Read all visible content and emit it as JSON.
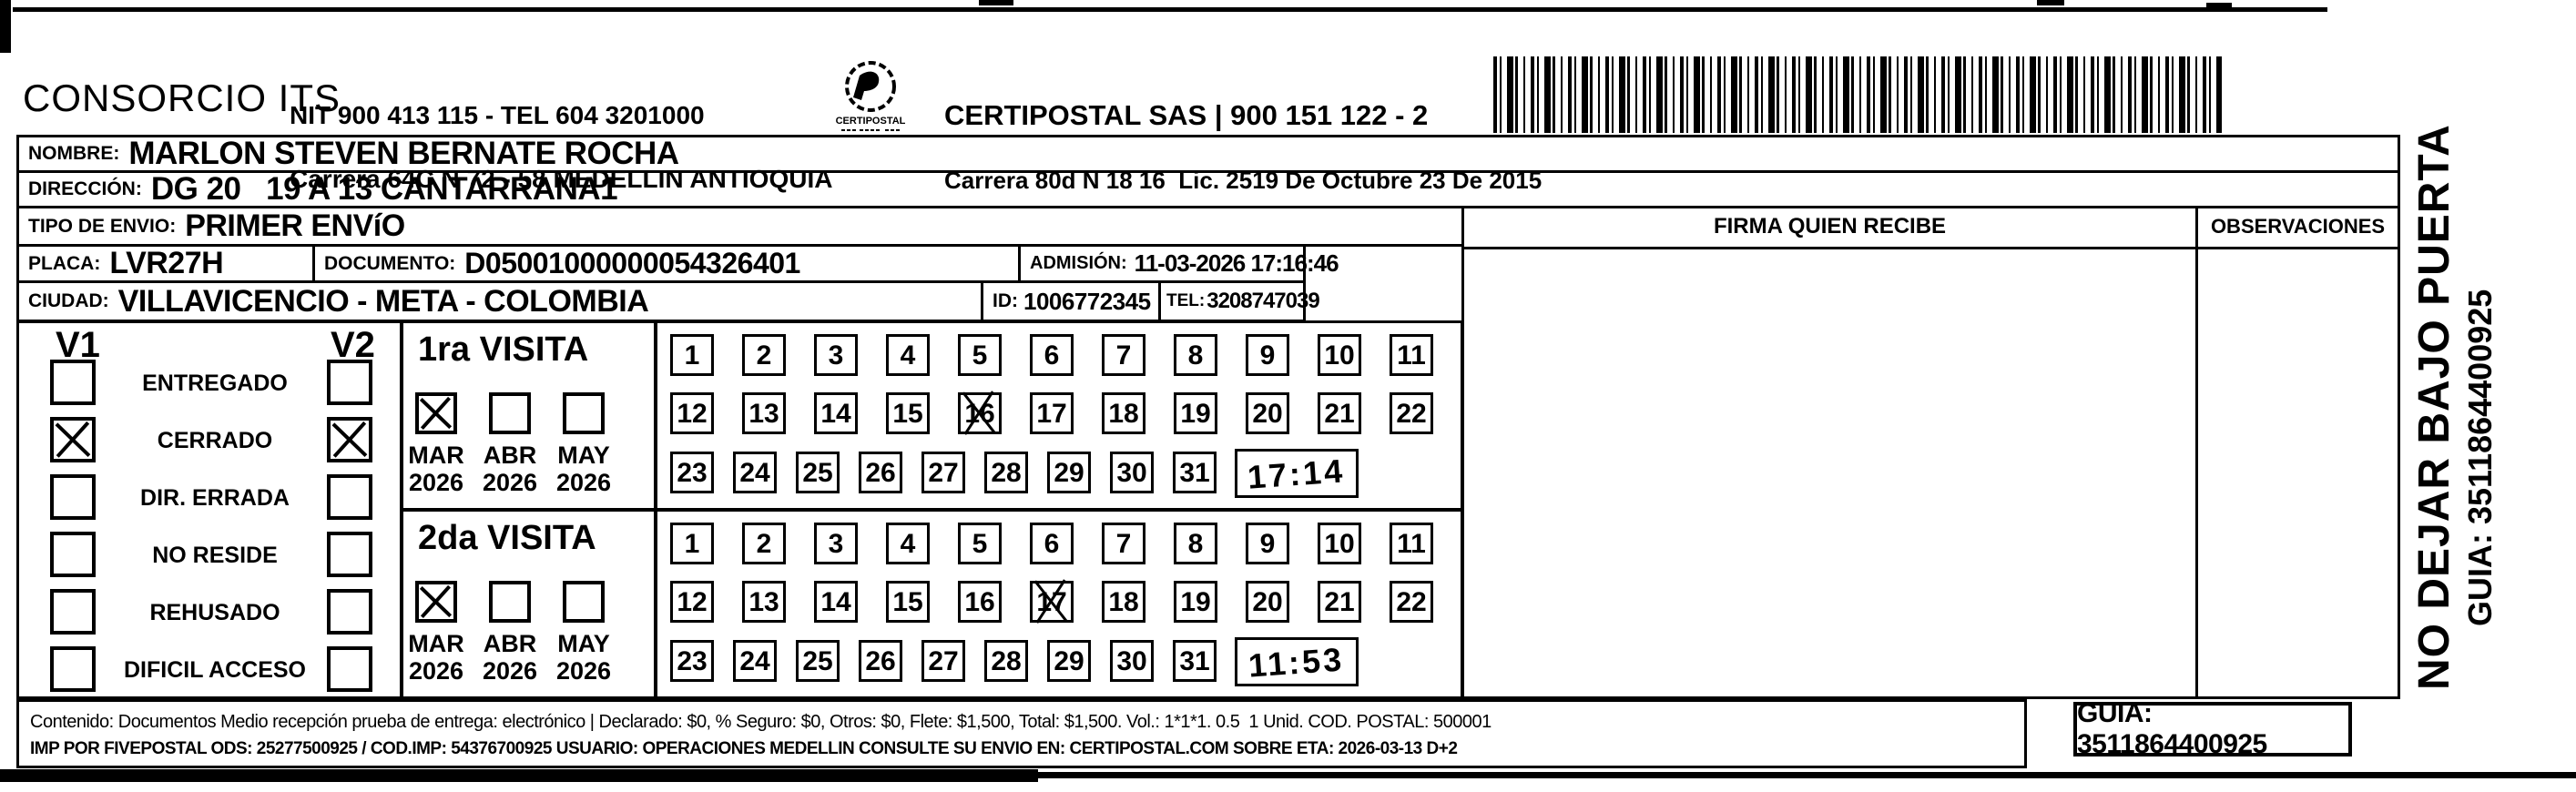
{
  "header": {
    "consorcio": "CONSORCIO ITS",
    "sender_line1": "NIT 900 413 115 - TEL 604 3201000",
    "sender_line2": "Carrera 64C N 72 - 58 MEDELLIN ANTIOQUIA",
    "logo_text": "CERTIPOSTAL",
    "carrier_line1": "CERTIPOSTAL SAS | 900 151 122 - 2",
    "carrier_line2": "Carrera 80d N 18 16  Lic. 2519 De Octubre 23 De 2015"
  },
  "shipment": {
    "nombre_label": "NOMBRE:",
    "nombre": "MARLON STEVEN BERNATE ROCHA",
    "direccion_label": "DIRECCIÓN:",
    "direccion": "DG 20   19 A 13 CANTARRANA1",
    "tipo_label": "TIPO DE ENVIO:",
    "tipo": "PRIMER ENVíO",
    "placa_label": "PLACA:",
    "placa": "LVR27H",
    "documento_label": "DOCUMENTO:",
    "documento": "D05001000000054326401",
    "admision_label": "ADMISIÓN:",
    "admision": "11-03-2026 17:16:46",
    "ciudad_label": "CIUDAD:",
    "ciudad": "VILLAVICENCIO - META - COLOMBIA",
    "id_label": "ID:",
    "id_value": "1006772345",
    "tel_label": "TEL:",
    "tel": "3208747039"
  },
  "columns": {
    "firma": "FIRMA QUIEN RECIBE",
    "observaciones": "OBSERVACIONES"
  },
  "status_panel": {
    "v1": "V1",
    "v2": "V2",
    "rows": [
      {
        "label": "ENTREGADO",
        "v1": false,
        "v2": false
      },
      {
        "label": "CERRADO",
        "v1": true,
        "v2": true
      },
      {
        "label": "DIR. ERRADA",
        "v1": false,
        "v2": false
      },
      {
        "label": "NO RESIDE",
        "v1": false,
        "v2": false
      },
      {
        "label": "REHUSADO",
        "v1": false,
        "v2": false
      },
      {
        "label": "DIFICIL ACCESO",
        "v1": false,
        "v2": false
      }
    ]
  },
  "visits": [
    {
      "title": "1ra VISITA",
      "months": [
        {
          "label": "MAR",
          "year": "2026",
          "checked": true
        },
        {
          "label": "ABR",
          "year": "2026",
          "checked": false
        },
        {
          "label": "MAY",
          "year": "2026",
          "checked": false
        }
      ],
      "days_in_month": 31,
      "crossed_day": 16,
      "handwritten_time": "17:14"
    },
    {
      "title": "2da VISITA",
      "months": [
        {
          "label": "MAR",
          "year": "2026",
          "checked": true
        },
        {
          "label": "ABR",
          "year": "2026",
          "checked": false
        },
        {
          "label": "MAY",
          "year": "2026",
          "checked": false
        }
      ],
      "days_in_month": 31,
      "crossed_day": 17,
      "handwritten_time": "11:53"
    }
  ],
  "side_note": {
    "message": "NO DEJAR BAJO PUERTA",
    "guia": "GUIA: 3511864400925"
  },
  "footer": {
    "line1": "Contenido: Documentos Medio recepción prueba de entrega: electrónico | Declarado: $0, % Seguro: $0, Otros: $0, Flete: $1,500, Total: $1,500. Vol.: 1*1*1. 0.5  1 Unid. COD. POSTAL: 500001",
    "line2": "IMP POR FIVEPOSTAL ODS: 25277500925 / COD.IMP: 54376700925 USUARIO: OPERACIONES MEDELLIN CONSULTE SU ENVIO EN: CERTIPOSTAL.COM SOBRE ETA: 2026-03-13 D+2",
    "guia_box": "GUIA: 3511864400925"
  }
}
